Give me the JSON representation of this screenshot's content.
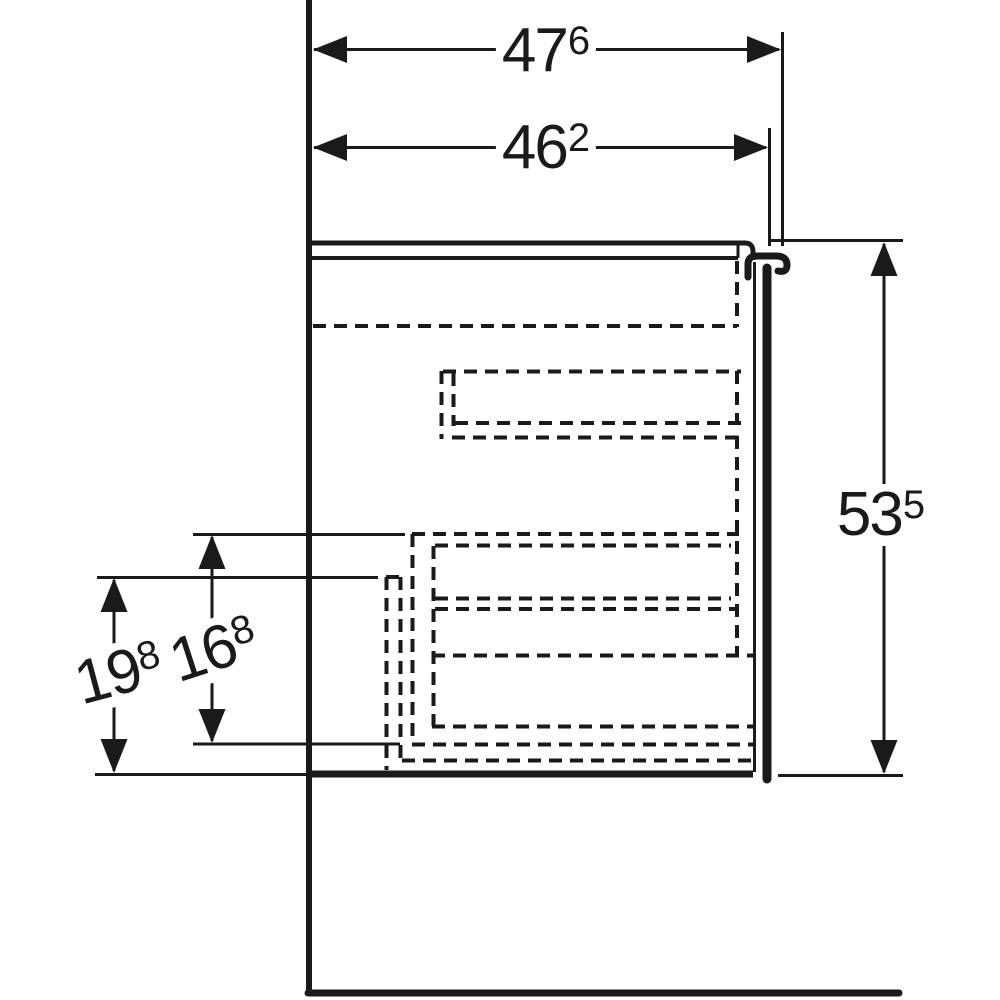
{
  "colors": {
    "ink": "#1a1a1a",
    "background": "#ffffff"
  },
  "drawing": {
    "dimension_labels": {
      "top_width": {
        "value": "47",
        "sup": "6"
      },
      "inner_width": {
        "value": "46",
        "sup": "2"
      },
      "right_height": {
        "value": "53",
        "sup": "5"
      },
      "drawer_height": {
        "value": "16",
        "sup": "8"
      },
      "lower_height": {
        "value": "19",
        "sup": "8"
      }
    }
  }
}
